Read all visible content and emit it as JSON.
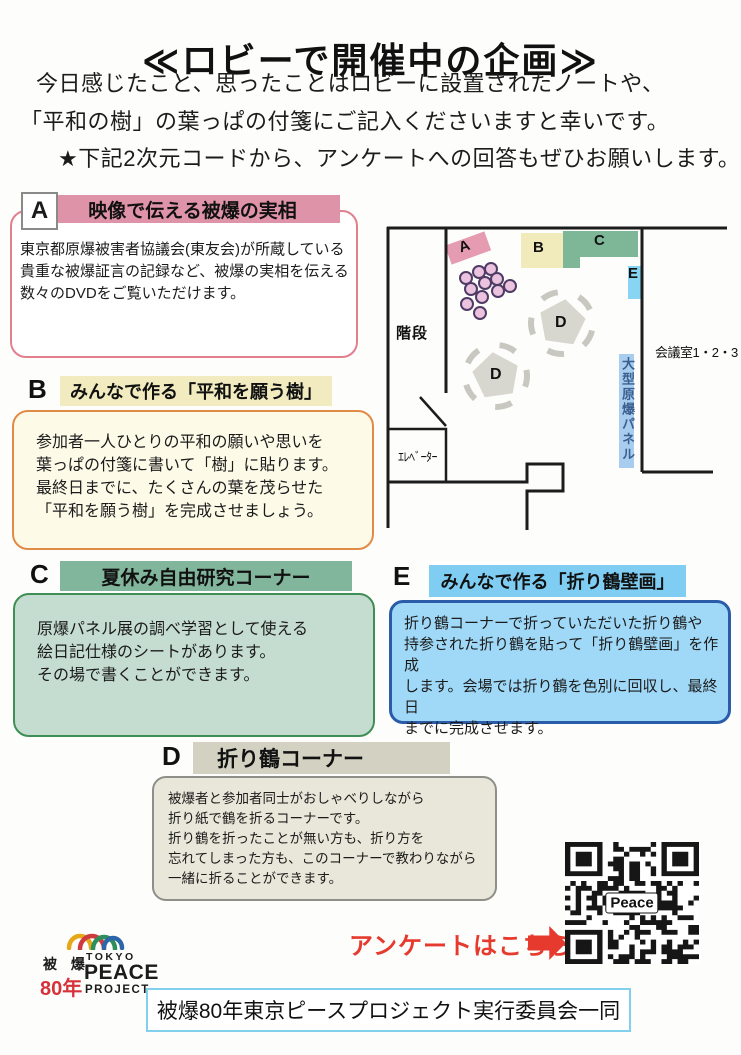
{
  "page": {
    "title": "≪ロビーで開催中の企画≫",
    "intro_line1": "今日感じたこと、思ったことはロビーに設置されたノートや、",
    "intro_line2": "「平和の樹」の葉っぱの付箋にご記入くださいますと幸いです。",
    "intro_line3": "★下記2次元コードから、アンケートへの回答もぜひお願いします。"
  },
  "sections": {
    "a": {
      "letter": "A",
      "title": "映像で伝える被爆の実相",
      "body": "東京都原爆被害者協議会(東友会)が所蔵している貴重な被爆証言の記録など、被爆の実相を伝える数々のDVDをご覧いただけます。",
      "header_color": "#df93a8",
      "border_color": "#e27f8d",
      "body_bg": "#ffffff"
    },
    "b": {
      "letter": "B",
      "title": "みんなで作る「平和を願う樹」",
      "body": "参加者一人ひとりの平和の願いや思いを\n葉っぱの付箋に書いて「樹」に貼ります。\n最終日までに、たくさんの葉を茂らせた\n「平和を願う樹」を完成させましょう。",
      "header_color": "#f1ebbf",
      "border_color": "#e28a47",
      "body_bg": "#fdfae8"
    },
    "c": {
      "letter": "C",
      "title": "夏休み自由研究コーナー",
      "body": "原爆パネル展の調べ学習として使える\n絵日記仕様のシートがあります。\nその場で書くことができます。",
      "header_color": "#82b69c",
      "border_color": "#3f8f55",
      "body_bg": "#c5dcd1"
    },
    "d": {
      "letter": "D",
      "title": "折り鶴コーナー",
      "body": "被爆者と参加者同士がおしゃべりしながら\n折り紙で鶴を折るコーナーです。\n折り鶴を折ったことが無い方も、折り方を\n忘れてしまった方も、このコーナーで教わりながら\n一緒に折ることができます。",
      "header_color": "#d3d2c2",
      "border_color": "#8f8f89",
      "body_bg": "#e9e7d9"
    },
    "e": {
      "letter": "E",
      "title": "みんなで作る「折り鶴壁画」",
      "body": "折り鶴コーナーで折っていただいた折り鶴や\n持参された折り鶴を貼って「折り鶴壁画」を作成\nします。会場では折り鶴を色別に回収し、最終日\nまでに完成させます。",
      "header_color": "#7fcdf2",
      "border_color": "#2a5caa",
      "body_bg": "#a0d9f7"
    }
  },
  "map": {
    "stairs_label": "階段",
    "elevator_label": "ｴﾚﾍﾞｰﾀｰ",
    "meeting_rooms_label": "会議室1・2・3",
    "panel_label": "大型原爆パネル",
    "zone_a": "A",
    "zone_b": "B",
    "zone_c": "C",
    "zone_e": "E",
    "table_d": "D",
    "colors": {
      "zone_a": "#e59cb1",
      "zone_b": "#f1ebbb",
      "zone_c": "#7eb698",
      "zone_e": "#88d5f3",
      "panel": "#a9cdee",
      "table": "#d8d7cf",
      "chair_circle_fill": "#ecc3de",
      "chair_circle_stroke": "#4f3c66"
    }
  },
  "survey": {
    "label": "アンケートはこちら",
    "qr_center_text": "Peace",
    "accent_color": "#e63a2e"
  },
  "logo": {
    "left_top": "被 爆",
    "left_bottom": "80年",
    "right_top": "TOKYO",
    "right_mid": "PEACE",
    "right_bottom": "PROJECT"
  },
  "footer": {
    "text": "被爆80年東京ピースプロジェクト実行委員会一同"
  }
}
